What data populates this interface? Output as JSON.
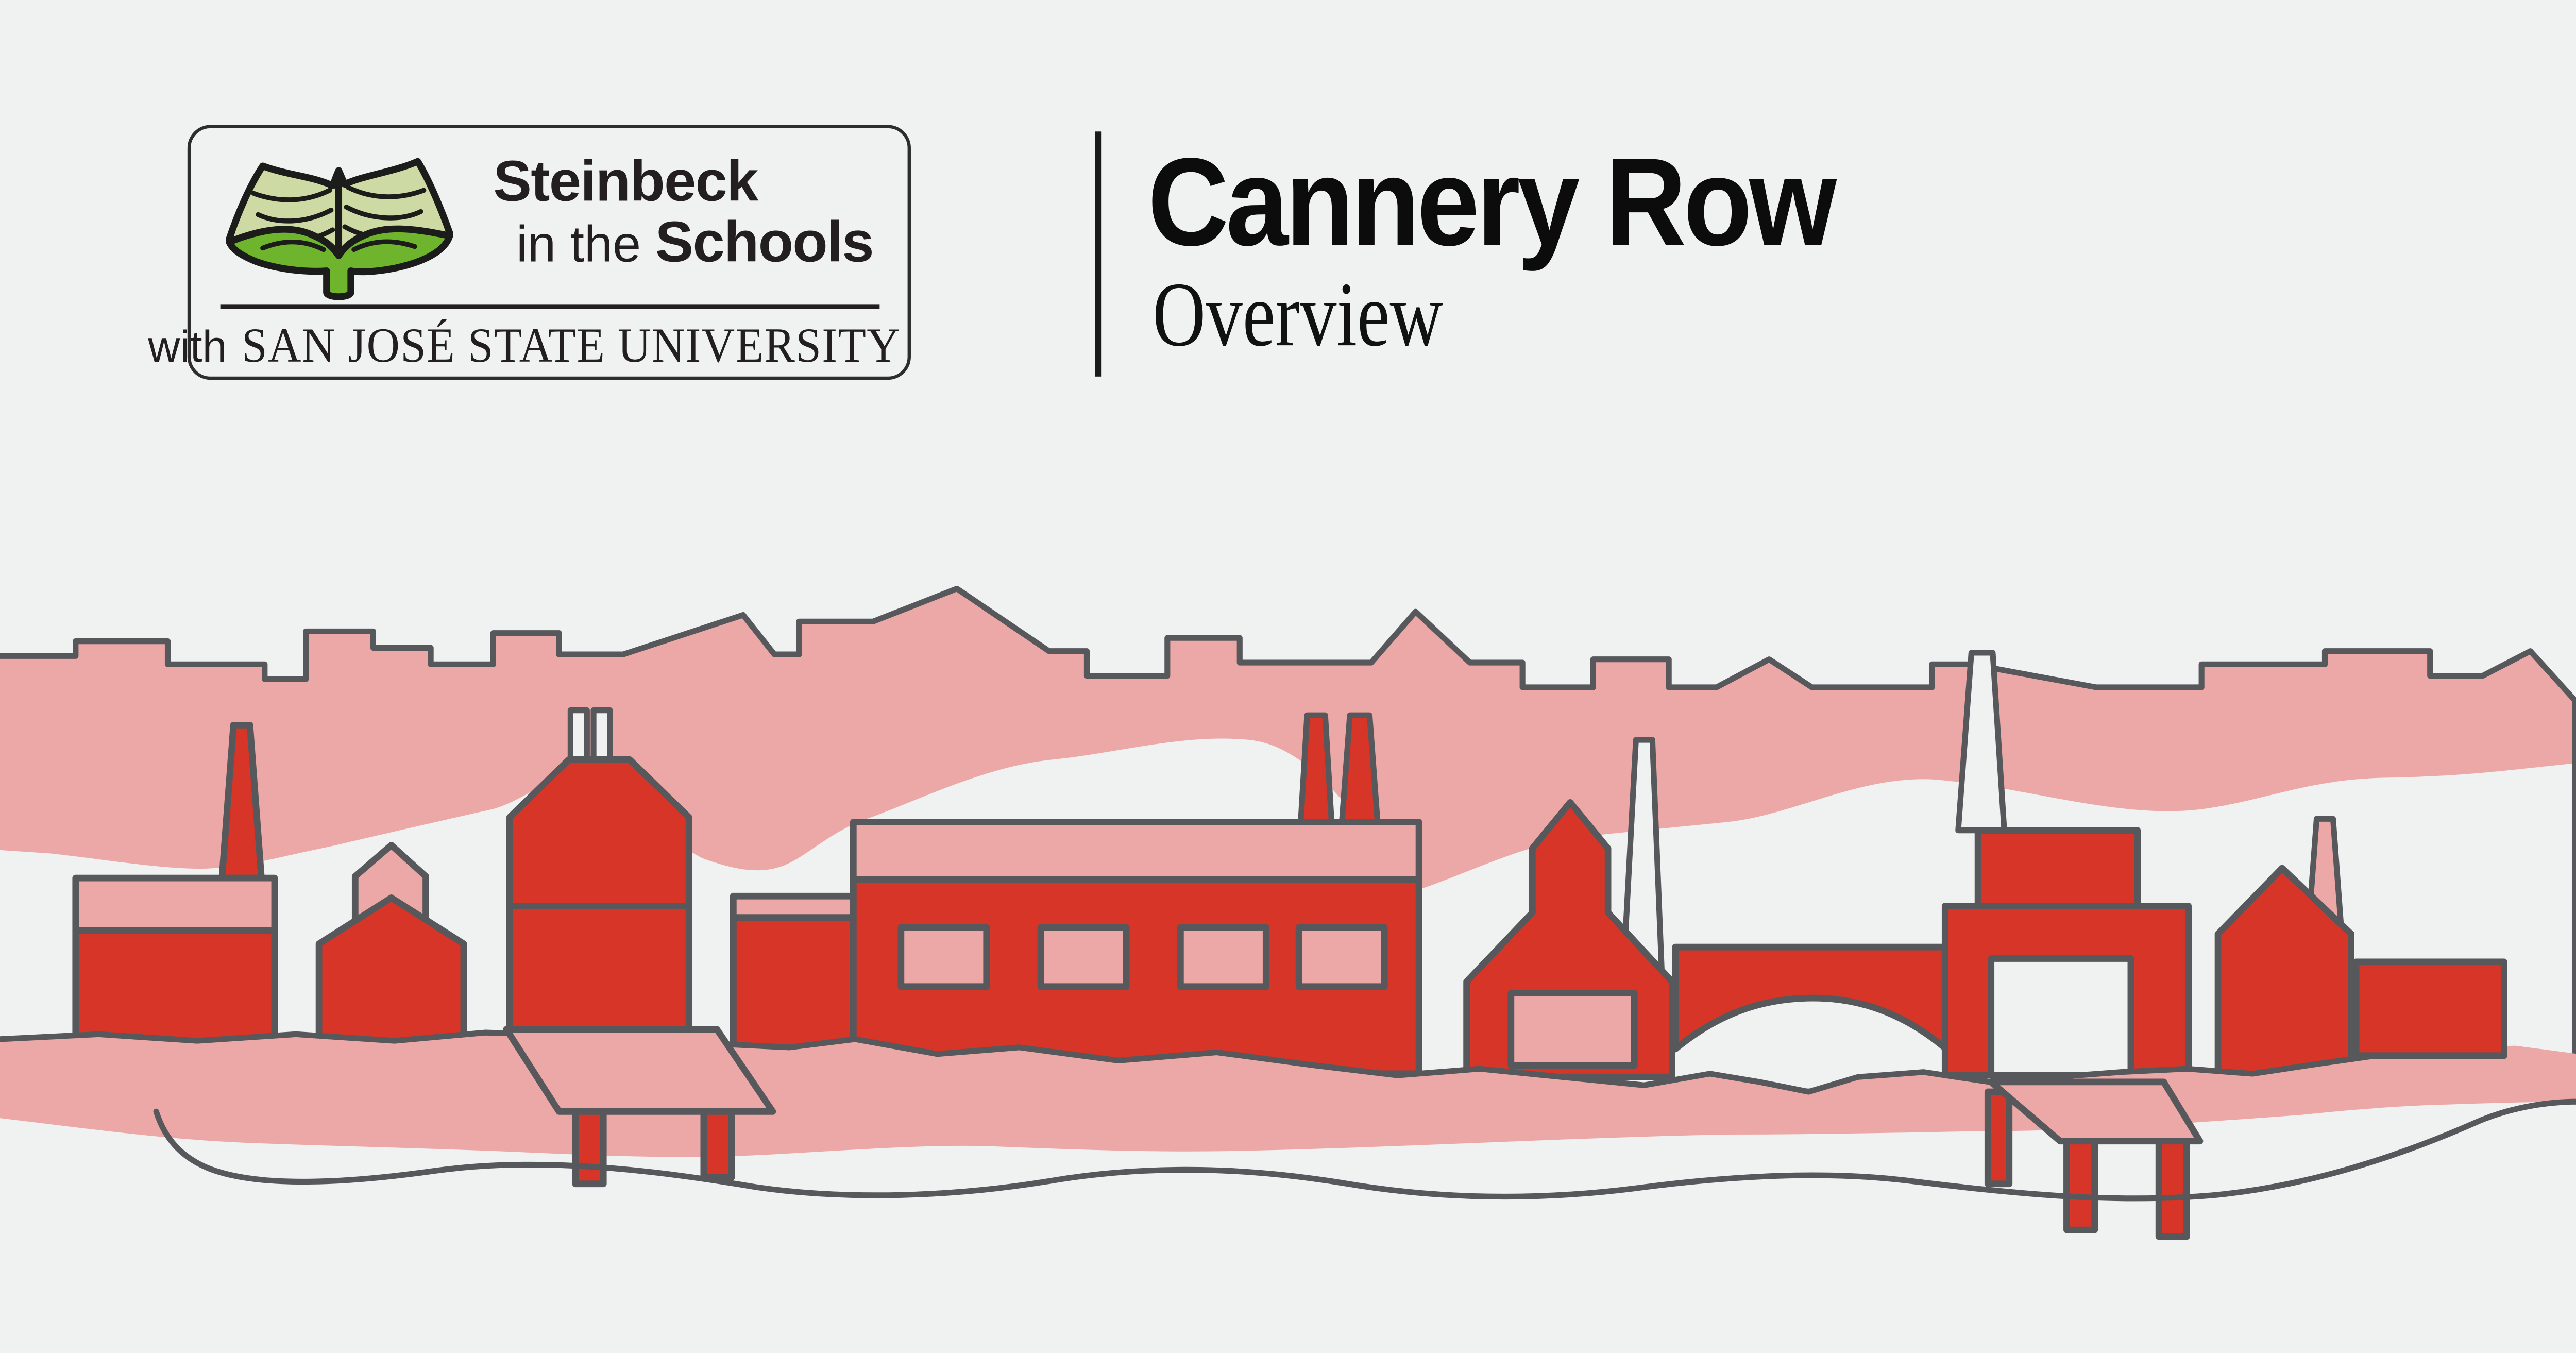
{
  "page": {
    "kind": "lesson title card"
  },
  "logo": {
    "icon": "open-book-icon",
    "line1": "Steinbeck",
    "line2_prefix": "in the",
    "line2_bold": "Schools",
    "tagline_prefix": "with",
    "tagline": "SAN JOSÉ STATE UNIVERSITY"
  },
  "title": {
    "heading": "Cannery Row",
    "subheading": "Overview"
  },
  "palette": {
    "background": "#f0f1f1",
    "pink": "#eca8a7",
    "red": "#d73527",
    "outline": "#57585b",
    "ink": "#231f20",
    "title_ink": "#0c0c0c",
    "logo_border": "#2d2d2d",
    "book_page_green": "#cddaa3",
    "book_cover_green": "#6eb42d",
    "book_outline": "#1c1c1a"
  },
  "illustration": {
    "name": "cannery-row-waterfront-illustration",
    "elements": [
      "background-skyline",
      "left-smokestack",
      "left-warehouse",
      "small-cannery-house",
      "roof-vent-stacks",
      "tall-cannery-building",
      "cannery-annex",
      "long-cannery-building",
      "cannery-windows",
      "twin-smokestacks",
      "peaked-cannery-building",
      "white-smokestack",
      "crossover-bridge",
      "right-cannery-building",
      "warehouse-door",
      "tall-white-smokestack",
      "right-gabled-house",
      "pink-smokestack",
      "shore-band",
      "right-low-warehouse",
      "left-pier",
      "right-pier",
      "shoreline-road"
    ]
  }
}
